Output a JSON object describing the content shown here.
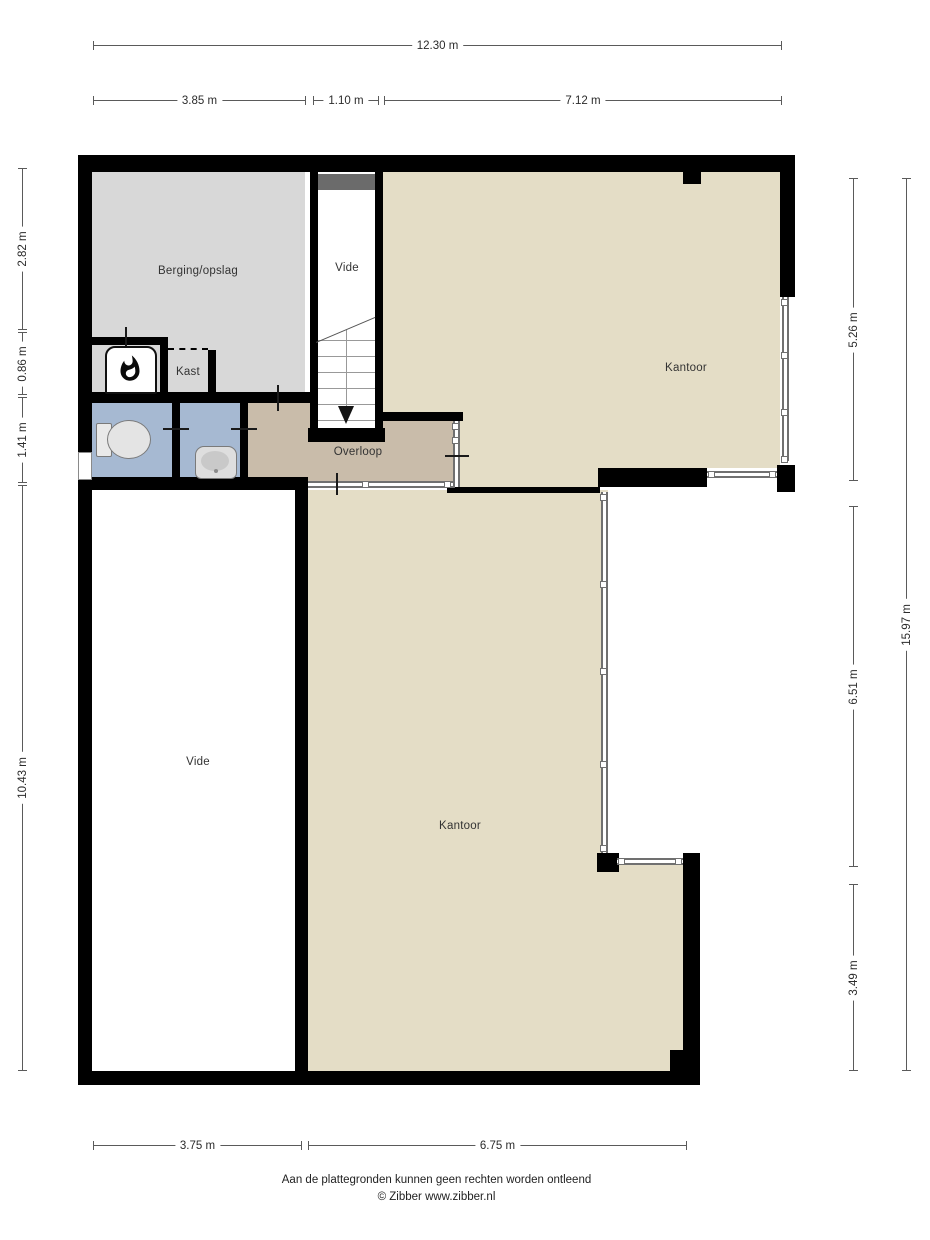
{
  "rooms": {
    "berging": "Berging/opslag",
    "vide_top": "Vide",
    "kast": "Kast",
    "overloop": "Overloop",
    "kantoor_top": "Kantoor",
    "vide_bottom": "Vide",
    "kantoor_bottom": "Kantoor"
  },
  "dimensions": {
    "top_total": "12.30 m",
    "top_segments": [
      "3.85 m",
      "1.10 m",
      "7.12 m"
    ],
    "left_segments": [
      "2.82 m",
      "0.86 m",
      "1.41 m",
      "10.43 m"
    ],
    "right_segments": [
      "5.26 m",
      "6.51 m",
      "3.49 m"
    ],
    "right_total": "15.97 m",
    "bottom_segments": [
      "3.75 m",
      "6.75 m"
    ]
  },
  "footer": {
    "disclaimer": "Aan de plattegronden kunnen geen rechten worden ontleend",
    "copyright": "© Zibber www.zibber.nl"
  },
  "colors": {
    "wall": "#000000",
    "floor_office": "#e4ddc6",
    "floor_landing": "#c9bcaa",
    "floor_storage": "#d8d8d8",
    "floor_toilet": "#a6b9d2",
    "stair_block": "#6b6b6b",
    "glass_line": "#707070",
    "dim_line": "#5a5a5a",
    "text": "#303030"
  }
}
